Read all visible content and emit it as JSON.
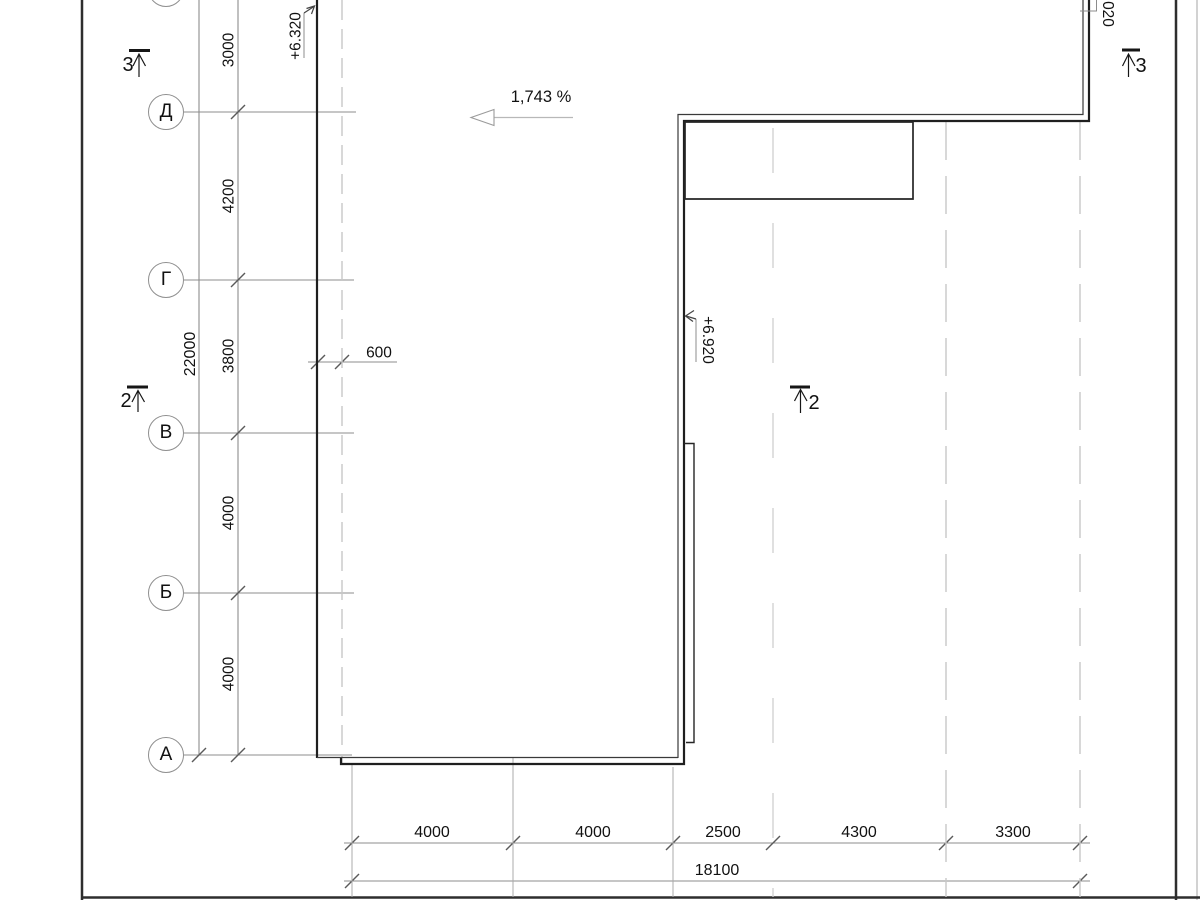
{
  "title": "roof-plan-fragment",
  "axis_labels": [
    "Д",
    "Г",
    "В",
    "Б",
    "А"
  ],
  "left_dims": {
    "overall": "22000",
    "segments": [
      "3000",
      "4200",
      "3800",
      "4000",
      "4000"
    ]
  },
  "bottom_dims": {
    "overall": "18100",
    "segments": [
      "4000",
      "4000",
      "2500",
      "4300",
      "3300"
    ]
  },
  "texts": {
    "slope": "1,743 %",
    "elev_left": "+6.320",
    "elev_mid": "+6.920",
    "elev_top_right_partial": "020",
    "overhang": "600"
  },
  "sections": {
    "left_top": "3",
    "left_mid": "2",
    "right_mid": "2",
    "right_top": "3"
  },
  "colors": {
    "building_line": "#1f1f1f",
    "thin_line": "#3a3a3a",
    "axis_line": "#8c8c8c",
    "dashed_line": "#c8c8c8",
    "text": "#111111"
  }
}
